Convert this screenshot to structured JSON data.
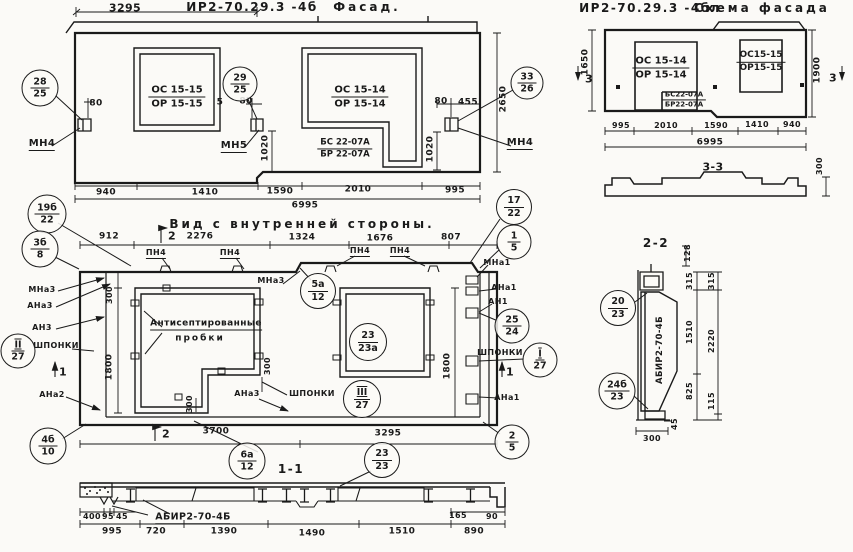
{
  "facade": {
    "code": "ИР2-70.29.3 -4б",
    "title": "Фасад.",
    "windows": {
      "w1_top": "ОС 15-15",
      "w1_bot": "ОР 15-15",
      "w2_top": "ОС 15-14",
      "w2_bot": "ОР 15-14",
      "panel_top": "БС 22-07А",
      "panel_bot": "БР 22-07А"
    },
    "anchors": {
      "mn4_left": "МН4",
      "mn5": "МН5",
      "mn4_right": "МН4"
    },
    "dims": {
      "top": "3295",
      "d80l": "80",
      "d5": "5",
      "d80m": "80",
      "d80r": "80",
      "d455": "455",
      "v1020l": "1020",
      "v1020r": "1020",
      "v2650": "2650",
      "bottom": [
        "940",
        "1410",
        "1590",
        "2010",
        "995"
      ],
      "total": "6995"
    }
  },
  "schema": {
    "code": "ИР2-70.29.3 -4бл",
    "title": "Схема фасада",
    "windows": {
      "w1_top": "ОС 15-14",
      "w1_bot": "ОР 15-14",
      "w2_top": "ОС15-15",
      "w2_bot": "ОР15-15",
      "panel_top": "БС22-07А",
      "panel_bot": "БР22-07А"
    },
    "dims": {
      "left": "1650",
      "right": "1900",
      "bottom": [
        "995",
        "2010",
        "1590",
        "1410",
        "940"
      ],
      "total": "6995",
      "profile": "300"
    },
    "section_label": "3",
    "section_title": "3-3"
  },
  "inner_view": {
    "title": "Вид с внутренней стороны.",
    "dims": {
      "top": [
        "912",
        "2276",
        "1324",
        "1676",
        "807"
      ],
      "v300": "300",
      "v1800l": "1800",
      "v1800r": "1800",
      "v300s1": "300",
      "v300s2": "300",
      "bottom": [
        "3700",
        "3295"
      ]
    },
    "labels": {
      "pn4": "ПН4",
      "mna3": "МНа3",
      "ana3": "АНа3",
      "an3": "АН3",
      "shponki": "ШПОНКИ",
      "ana2": "АНа2",
      "mna1": "МНа1",
      "ana1": "АНа1",
      "an1": "АН1",
      "note1": "Антисептированные",
      "note2": "пробки"
    },
    "section_marks": {
      "s1": "1",
      "s2": "2"
    }
  },
  "section_1_1": {
    "title": "1-1",
    "beam_label": "АБИР2-70-4Б",
    "dims": {
      "sub": [
        "400",
        "95",
        "45"
      ],
      "row": [
        "995",
        "720",
        "1390",
        "1490",
        "1510",
        "890"
      ],
      "d165": "165",
      "d90": "90"
    }
  },
  "section_2_2": {
    "title": "2-2",
    "beam_label": "АБИР2-70-4Б",
    "dims": {
      "d128": "128",
      "d315a": "315",
      "d315b": "315",
      "d1510": "1510",
      "d2220": "2220",
      "d825": "825",
      "d115": "115",
      "d45": "45",
      "d300": "300"
    }
  },
  "callouts": {
    "c28": {
      "top": "28",
      "bot": "25"
    },
    "c29": {
      "top": "29",
      "bot": "25"
    },
    "c33": {
      "top": "33",
      "bot": "26"
    },
    "c19b": {
      "top": "19б",
      "bot": "22"
    },
    "c3b": {
      "top": "3б",
      "bot": "8"
    },
    "c17": {
      "top": "17",
      "bot": "22"
    },
    "c1": {
      "top": "1",
      "bot": "5"
    },
    "c5a": {
      "top": "5а",
      "bot": "12"
    },
    "c23a": {
      "top": "23",
      "bot": "23а"
    },
    "c25": {
      "top": "25",
      "bot": "24"
    },
    "cII": {
      "top": "II",
      "bot": "27"
    },
    "cI": {
      "top": "I",
      "bot": "27"
    },
    "cIII": {
      "top": "III",
      "bot": "27"
    },
    "c2": {
      "top": "2",
      "bot": "5"
    },
    "c4b": {
      "top": "4б",
      "bot": "10"
    },
    "c6a": {
      "top": "6а",
      "bot": "12"
    },
    "c23": {
      "top": "23",
      "bot": "23"
    },
    "c20": {
      "top": "20",
      "bot": "23"
    },
    "c24b": {
      "top": "24б",
      "bot": "23"
    }
  }
}
